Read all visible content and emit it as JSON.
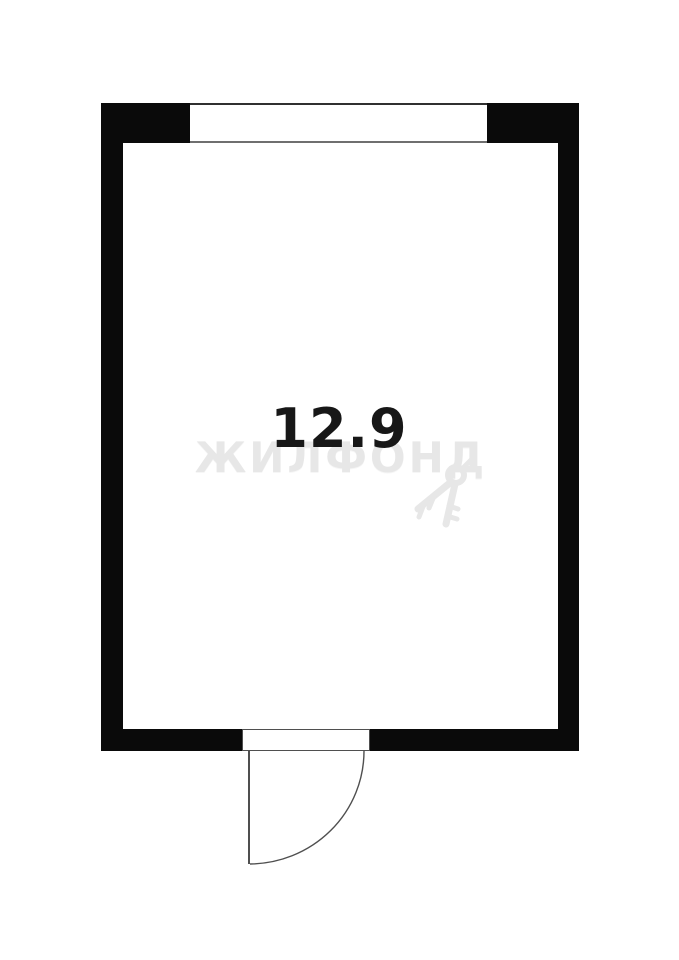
{
  "floor_plan": {
    "room": {
      "area_label": "12.9"
    },
    "watermark": {
      "text": "ЖИЛФОНД",
      "icon": "keys-icon"
    },
    "colors": {
      "wall": "#0a0a0a",
      "line": "#4f4f4f",
      "window_sill": "#6f6f6f",
      "area_text": "#171717",
      "watermark": "#e7e7e7",
      "background": "#ffffff"
    }
  }
}
